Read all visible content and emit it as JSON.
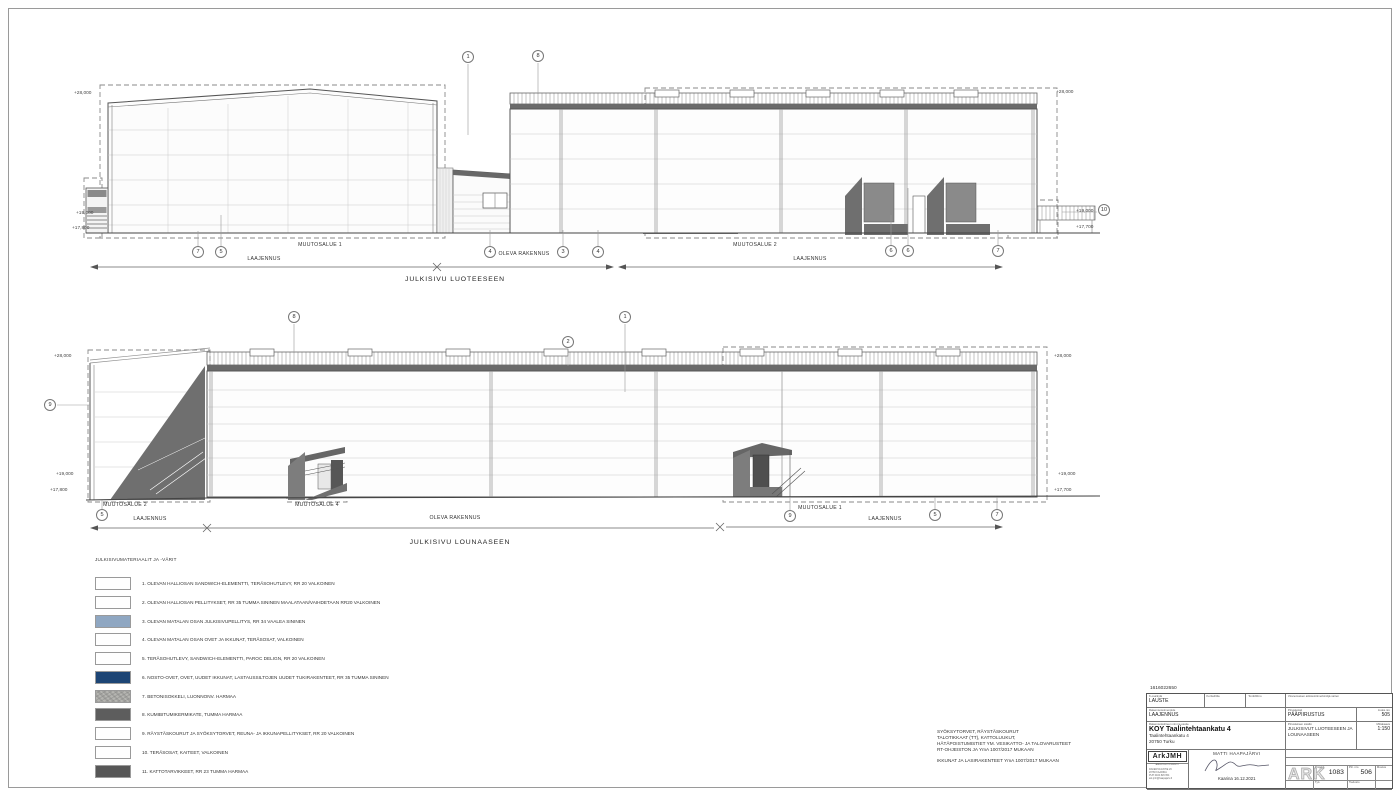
{
  "d1": {
    "title": "JULKISIVU LUOTEESEEN",
    "area1": "MUUTOSALUE 1",
    "area2": "MUUTOSALUE 2",
    "laajennus_left": "LAAJENNUS",
    "oleva_rakennus": "OLEVA RAKENNUS",
    "laajennus_right": "LAAJENNUS",
    "elev": {
      "l_top": "+28,000",
      "l_mid": "+19,000",
      "l_low": "+17,800",
      "r_top": "+28,000",
      "r_mid": "+19,000",
      "r_low": "+17,700"
    },
    "callouts": {
      "c1": "1",
      "c8": "8",
      "c7a": "7",
      "c5": "5",
      "c4a": "4",
      "c3": "3",
      "c4b": "4",
      "c6a": "6",
      "c6b": "6",
      "c7b": "7",
      "c10": "10"
    }
  },
  "d2": {
    "title": "JULKISIVU LOUNAASEEN",
    "area2": "MUUTOSALUE 2",
    "area4": "MUUTOSALUE 4",
    "area1": "MUUTOSALUE 1",
    "laajennus_left": "LAAJENNUS",
    "oleva_rakennus": "OLEVA RAKENNUS",
    "laajennus_right": "LAAJENNUS",
    "elev": {
      "l_top": "+28,000",
      "l_mid": "+19,000",
      "l_low": "+17,800",
      "r_top": "+28,000",
      "r_mid": "+19,000",
      "r_low": "+17,700"
    },
    "callouts": {
      "c8": "8",
      "c2": "2",
      "c1": "1",
      "c9_left": "9",
      "c5_left": "5",
      "c9": "9",
      "c5": "5",
      "c7": "7"
    }
  },
  "legend": {
    "title": "JULKISIVUMATERIAALIT JA -VÄRIT",
    "items": [
      {
        "text": "1. OLEVAN HALLIOSAN SANDWICH-ELEMENTTI, TERÄSOHUTLEVY, RR 20 VALKOINEN",
        "swatch": "#ffffff"
      },
      {
        "text": "2. OLEVAN HALLIOSAN PELLITYKSET, RR 35 TUMMA SININEN MAALATAAN/VAIHDETAAN RR20 VALKOINEN",
        "swatch": "#ffffff"
      },
      {
        "text": "3. OLEVAN MATALAN OSAN JULKISIVUPELLITYS, RR 34 VAALEA SININEN",
        "swatch": "#8fa7c2"
      },
      {
        "text": "4. OLEVAN MATALAN OSAN OVET JA IKKUNAT, TERÄSOSAT, VALKOINEN",
        "swatch": "#ffffff"
      },
      {
        "text": "5. TERÄSOHUTLEVY, SANDWICH-ELEMENTTI, PAROC DELIGN, RR 20 VALKOINEN",
        "swatch": "#ffffff"
      },
      {
        "text": "6. NOSTO-OVET, OVET, UUDET IKKUNAT, LASTAUSSILTOJEN UUDET TUKIRAKENTEET, RR 35 TUMMA SININEN",
        "swatch": "#1d4575"
      },
      {
        "text": "7. BETONISOKKELI, LUONNONV. HARMAA",
        "swatch": "#b5b5b1"
      },
      {
        "text": "8. KUMIBITUMIKERMIKATE, TUMMA HARMAA",
        "swatch": "#5d5d5d"
      },
      {
        "text": "9. RÄYSTÄSKOURUT JA SYÖKSYTORVET, REUNA- JA IKKUNAPELLITYKSET, RR 20 VALKOINEN",
        "swatch": "#ffffff"
      },
      {
        "text": "10. TERÄSOSAT, KAITEET, VALKOINEN",
        "swatch": "#ffffff"
      },
      {
        "text": "11. KATTOTARVIKKEET, RR 23 TUMMA HARMAA",
        "swatch": "#575757"
      }
    ]
  },
  "notes": {
    "line1": "SYÖKSYTORVET, RÄYSTÄSKOURUT",
    "line2": "TALOTIKKAAT (TT), KATTOLUUKUT,",
    "line3": "HÄTÄPOISTUMISTIET YM. VESIKATTO- JA TALOVARUSTEET",
    "line4": "RT-OHJEISTON JA YmA 1007/2017 MUKAAN",
    "line5": "IKKUNAT JA LASIRAKENTEET YmA 1007/2017 MUKAAN"
  },
  "titleblock": {
    "permit_id": "1616022650",
    "row1": {
      "label1": "K.osa/kylä",
      "value1": "LAUSTE",
      "label2": "Kortteli/tila",
      "label3": "Tontti/Rnro",
      "label_right": "Viranomaisen arkistointimerkintöjä varten"
    },
    "row2": {
      "label1": "Rakennustoimenpide",
      "value1": "LAAJENNUS",
      "label2": "Piirustuslaji",
      "value2": "PÄÄPIIRUSTUS",
      "label3": "Juoks.nro",
      "value3": "505"
    },
    "row3": {
      "label1": "Rakennuskohteen nimi ja osoite",
      "name": "KOY Taalintehtaankatu 4",
      "addr1": "Taalintehtaankatu 4",
      "addr2": "20750 Turku",
      "label2": "Piirustuksen sisältö",
      "content1": "JULKISIVUT LUOTEESEEN JA",
      "content2": "LOUNAASEEN",
      "label3": "Mittakaava",
      "scale": "1:150"
    },
    "firm": {
      "logo": "ArkJMH",
      "tagline": "ARKKITEHTITOIMISTO",
      "addr1": "RAKENTAJANTIE 26",
      "addr2": "20780 KAARINA",
      "addr3": "PUH 0400 826 654",
      "addr4": "ark.jmh@haapajarvi.fi"
    },
    "signer": {
      "name": "MATTI HAAPAJÄRVI",
      "place_date": "Kaarina 16.12.2021"
    },
    "stamp": "ARK",
    "numbers": {
      "label_proj": "Projekti",
      "proj": "1083",
      "label_no": "Piir. nro",
      "no": "506",
      "label_rev": "Muutos",
      "label_work": "Työ",
      "label_file": "Tiedosto"
    }
  }
}
